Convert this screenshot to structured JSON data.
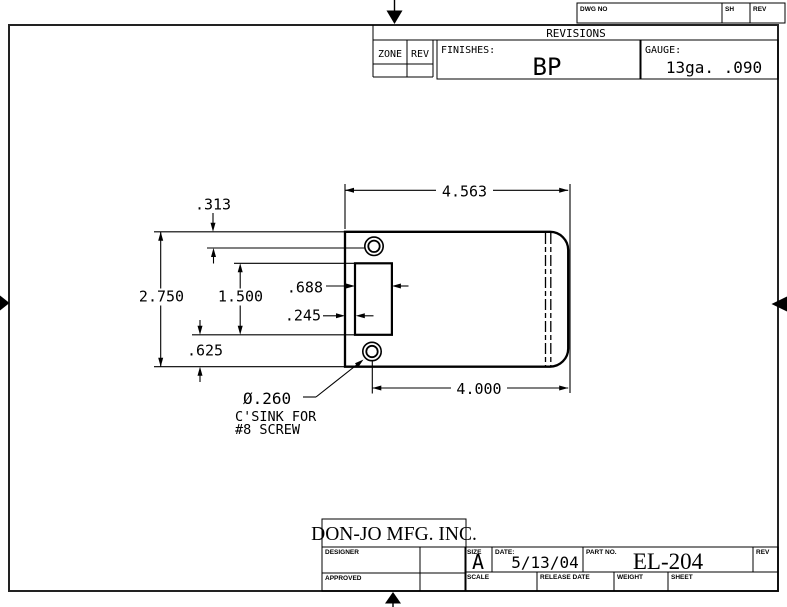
{
  "sheet": {
    "top_strip": {
      "dwg_no_label": "DWG NO",
      "sh_label": "SH",
      "rev_label": "REV"
    },
    "revisions": {
      "title": "REVISIONS",
      "zone_label": "ZONE",
      "rev_label": "REV",
      "finishes_label": "FINISHES:",
      "finishes_value": "BP",
      "gauge_label": "GAUGE:",
      "gauge_value": "13ga.  .090"
    },
    "drawing": {
      "dimensions": {
        "overall_width": "4.563",
        "hole_span": "4.000",
        "overall_height": "2.750",
        "top_hole_offset": ".313",
        "cutout_height": "1.500",
        "cutout_width": ".688",
        "cutout_inset": ".245",
        "bottom_inset": ".625"
      },
      "hole_note": {
        "diameter": "Ø.260",
        "line2": "C'SINK FOR",
        "line3": "#8 SCREW"
      }
    },
    "title_block": {
      "company": "DON-JO MFG. INC.",
      "designer_label": "DESIGNER",
      "approved_label": "APPROVED",
      "size_label": "SIZE",
      "size_value": "A",
      "date_label": "DATE:",
      "date_value": "5/13/04",
      "part_no_label": "PART NO.",
      "part_no_value": "EL-204",
      "rev_label": "REV",
      "scale_label": "SCALE",
      "release_date_label": "RELEASE DATE",
      "weight_label": "WEIGHT",
      "sheet_label": "SHEET"
    }
  }
}
